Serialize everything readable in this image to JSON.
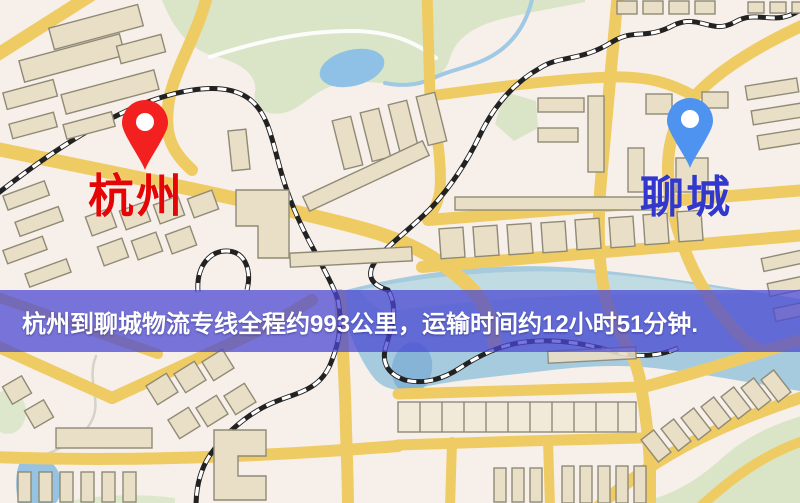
{
  "page": {
    "width": 800,
    "height": 503,
    "kind": "logistics-route-map"
  },
  "banner": {
    "text": "杭州到聊城物流专线全程约993公里，运输时间约12小时51分钟.",
    "origin": "杭州",
    "destination": "聊城",
    "distance": "993公里",
    "duration": "12小时51分钟",
    "bg_color": "#4a48d2",
    "text_color": "#ffffff"
  },
  "markers": {
    "origin": {
      "label": "杭州",
      "label_color": "#e60505",
      "pin_color": "#f32020"
    },
    "destination": {
      "label": "聊城",
      "label_color": "#3238cc",
      "pin_color": "#4f93f0"
    }
  },
  "map": {
    "type": "stylized-street-map",
    "colors": {
      "background": "#f7efe9",
      "road": "#efcb64",
      "park": "#d9e5c6",
      "river": "#a6cbdf",
      "lake": "#8fc0e6",
      "building": "#e9dec6",
      "railway": "#222222"
    },
    "features": [
      "roads",
      "railways",
      "parks",
      "lakes",
      "river",
      "buildings"
    ]
  }
}
